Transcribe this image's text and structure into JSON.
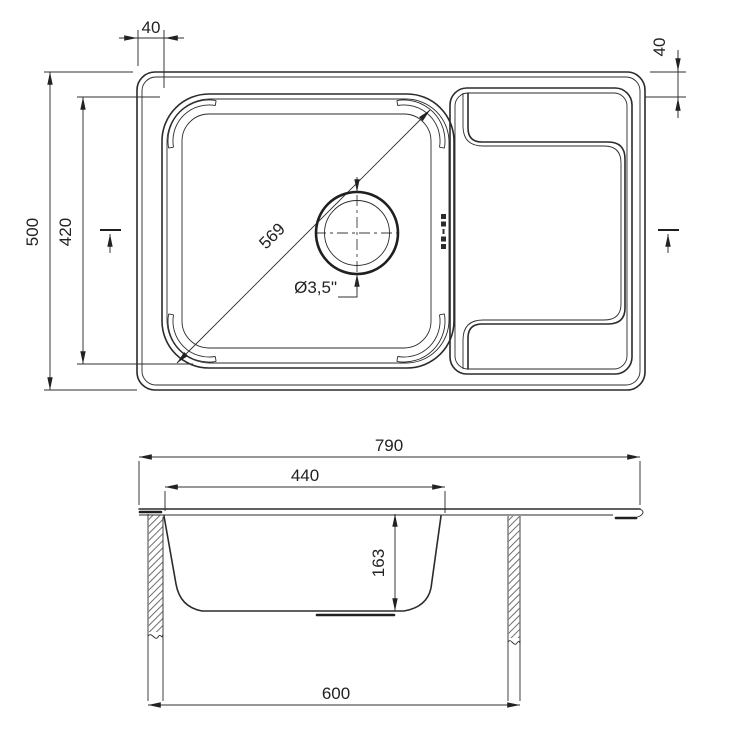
{
  "top": {
    "dim_flange_top": "40",
    "dim_flange_right": "40",
    "dim_overall_depth": "500",
    "dim_bowl_inner_depth": "420",
    "dim_bowl_diagonal": "569",
    "dim_drain_diameter": "Ø3,5\""
  },
  "section": {
    "dim_overall_width": "790",
    "dim_bowl_width": "440",
    "dim_bowl_depth": "163",
    "dim_cabinet_width": "600"
  },
  "colors": {
    "line": "#2b2b2b",
    "background": "#ffffff"
  }
}
